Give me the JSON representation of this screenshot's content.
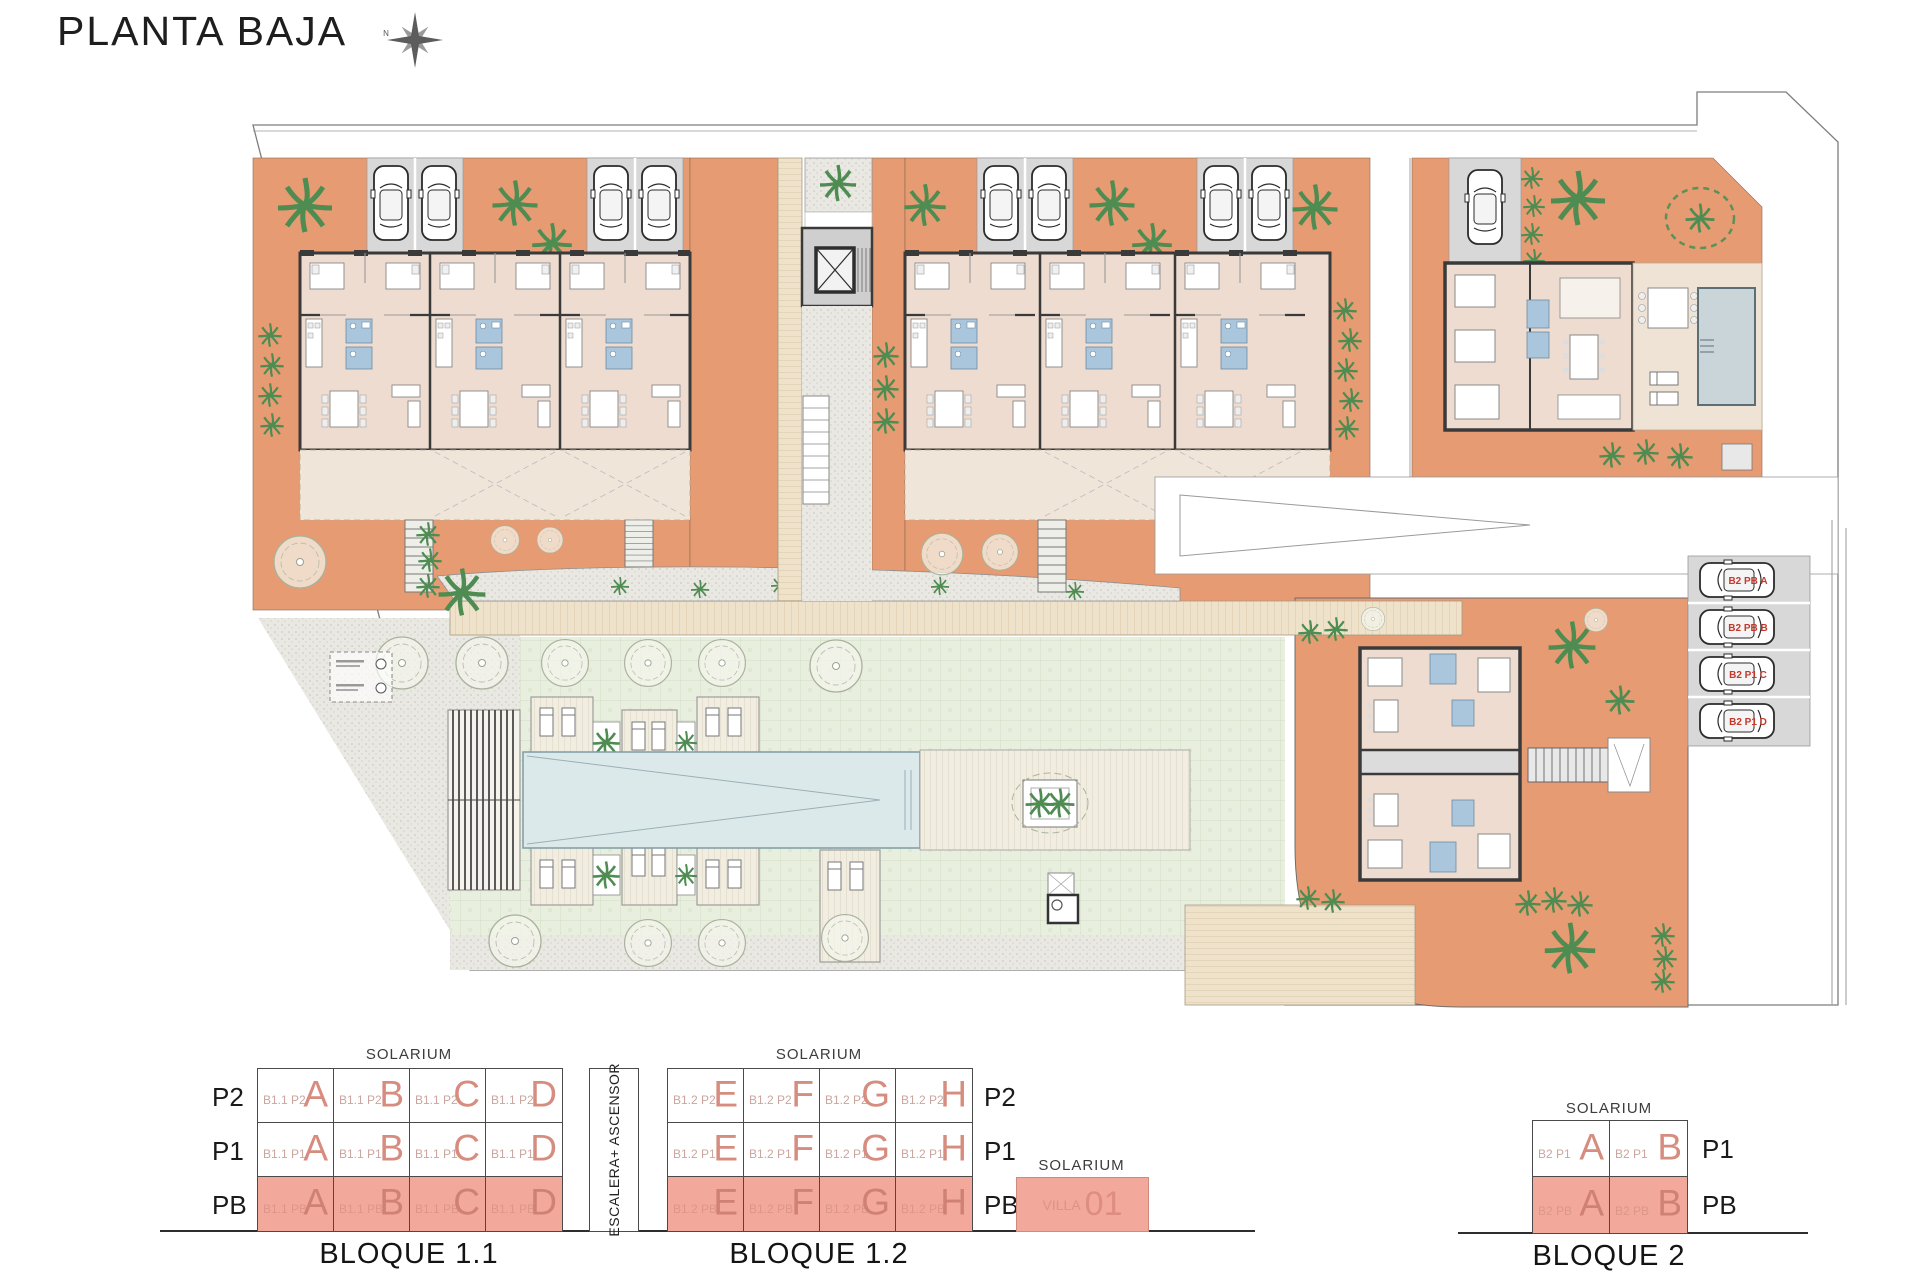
{
  "title": "PLANTA BAJA",
  "compass": {
    "north": "N"
  },
  "site": {
    "parking_labels": {
      "a": "B2 PB A",
      "b": "B2 PB B",
      "c": "B2 P1 C",
      "d": "B2 P1 D"
    }
  },
  "schematic": {
    "solarium": "SOLARIUM",
    "escalera": "ESCALERA+ ASCENSOR",
    "bloque11": {
      "caption": "BLOQUE 1.1",
      "floor_labels": [
        "P2",
        "P1",
        "PB"
      ],
      "rows": [
        {
          "cells": [
            {
              "code": "B1.1 P2",
              "unit": "A"
            },
            {
              "code": "B1.1 P2",
              "unit": "B"
            },
            {
              "code": "B1.1 P2",
              "unit": "C"
            },
            {
              "code": "B1.1 P2",
              "unit": "D"
            }
          ]
        },
        {
          "cells": [
            {
              "code": "B1.1 P1",
              "unit": "A"
            },
            {
              "code": "B1.1 P1",
              "unit": "B"
            },
            {
              "code": "B1.1 P1",
              "unit": "C"
            },
            {
              "code": "B1.1 P1",
              "unit": "D"
            }
          ]
        },
        {
          "cells": [
            {
              "code": "B1.1 PB",
              "unit": "A"
            },
            {
              "code": "B1.1 PB",
              "unit": "B"
            },
            {
              "code": "B1.1 PB",
              "unit": "C"
            },
            {
              "code": "B1.1 PB",
              "unit": "D"
            }
          ]
        }
      ]
    },
    "bloque12": {
      "caption": "BLOQUE 1.2",
      "floor_labels": [
        "P2",
        "P1",
        "PB"
      ],
      "rows": [
        {
          "cells": [
            {
              "code": "B1.2 P2",
              "unit": "E"
            },
            {
              "code": "B1.2 P2",
              "unit": "F"
            },
            {
              "code": "B1.2 P2",
              "unit": "G"
            },
            {
              "code": "B1.2 P2",
              "unit": "H"
            }
          ]
        },
        {
          "cells": [
            {
              "code": "B1.2 P1",
              "unit": "E"
            },
            {
              "code": "B1.2 P1",
              "unit": "F"
            },
            {
              "code": "B1.2 P1",
              "unit": "G"
            },
            {
              "code": "B1.2 P1",
              "unit": "H"
            }
          ]
        },
        {
          "cells": [
            {
              "code": "B1.2 PB",
              "unit": "E"
            },
            {
              "code": "B1.2 PB",
              "unit": "F"
            },
            {
              "code": "B1.2 PB",
              "unit": "G"
            },
            {
              "code": "B1.2 PB",
              "unit": "H"
            }
          ]
        }
      ]
    },
    "villa": {
      "solarium": "SOLARIUM",
      "code": "VILLA",
      "number": "01"
    },
    "bloque2": {
      "caption": "BLOQUE 2",
      "floor_labels": [
        "P1",
        "PB"
      ],
      "rows": [
        {
          "cells": [
            {
              "code": "B2 P1",
              "unit": "A"
            },
            {
              "code": "B2 P1",
              "unit": "B"
            }
          ]
        },
        {
          "cells": [
            {
              "code": "B2 PB",
              "unit": "A"
            },
            {
              "code": "B2 PB",
              "unit": "B"
            }
          ]
        }
      ]
    }
  }
}
